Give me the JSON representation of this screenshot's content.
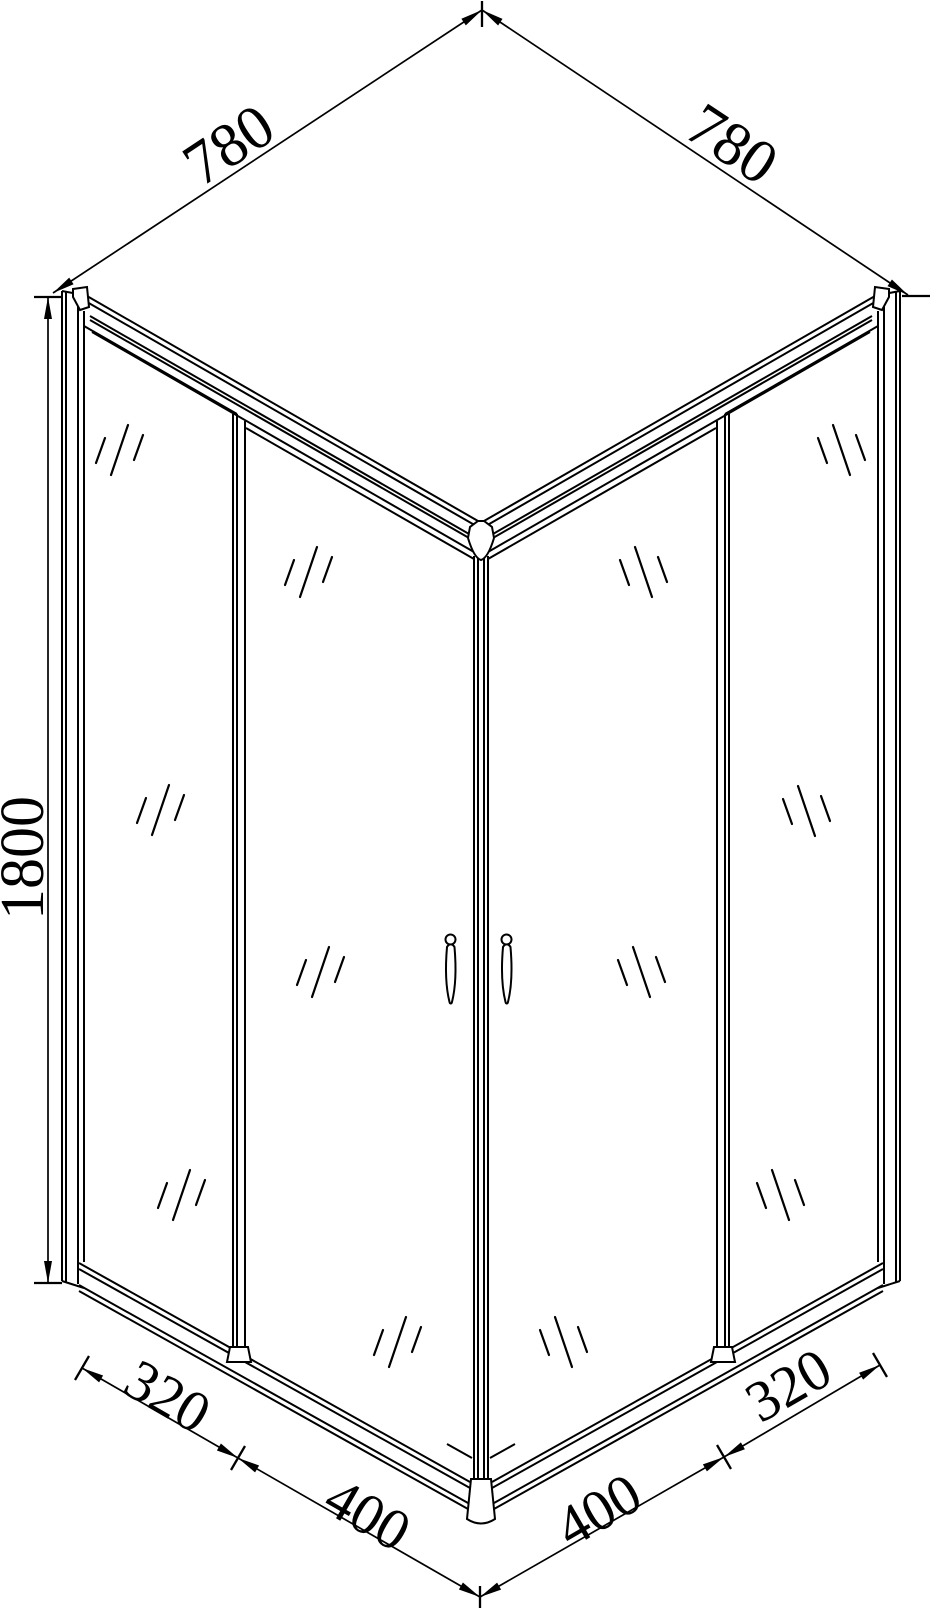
{
  "drawing": {
    "title": "Corner shower enclosure isometric technical drawing",
    "units": "mm",
    "line_color": "#000000",
    "background_color": "#ffffff",
    "labels": {
      "top_left_width": "780",
      "top_right_width": "780",
      "height": "1800",
      "bottom_left_panel": "320",
      "bottom_left_door": "400",
      "bottom_right_door": "400",
      "bottom_right_panel": "320"
    }
  }
}
